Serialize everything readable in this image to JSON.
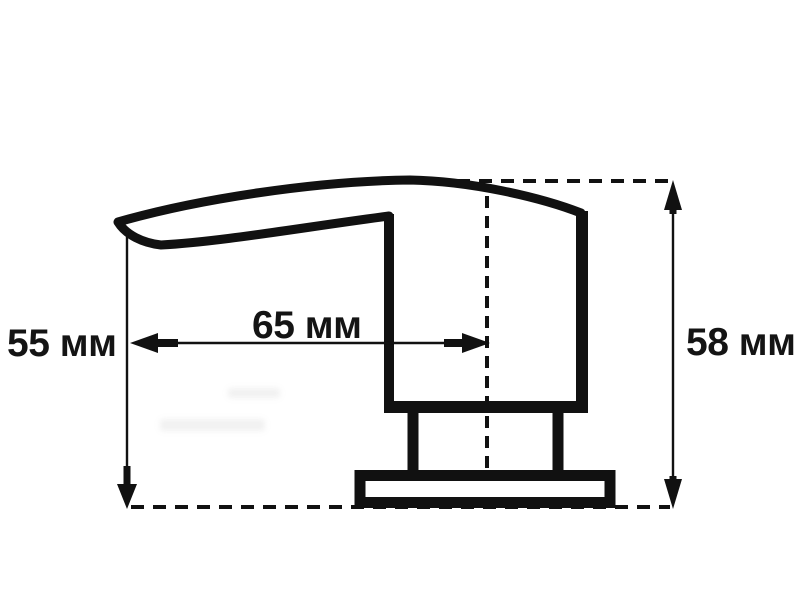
{
  "page": {
    "background_color": "#ffffff",
    "line_color": "#111111"
  },
  "drawing": {
    "kind": "dimensioned-technical-drawing",
    "labels": {
      "left_height": "55 мм",
      "horizontal_reach": "65 мм",
      "right_height": "58 мм"
    },
    "values": {
      "left_height_mm": 55,
      "horizontal_reach_mm": 65,
      "right_height_mm": 58,
      "unit": "мм"
    }
  }
}
